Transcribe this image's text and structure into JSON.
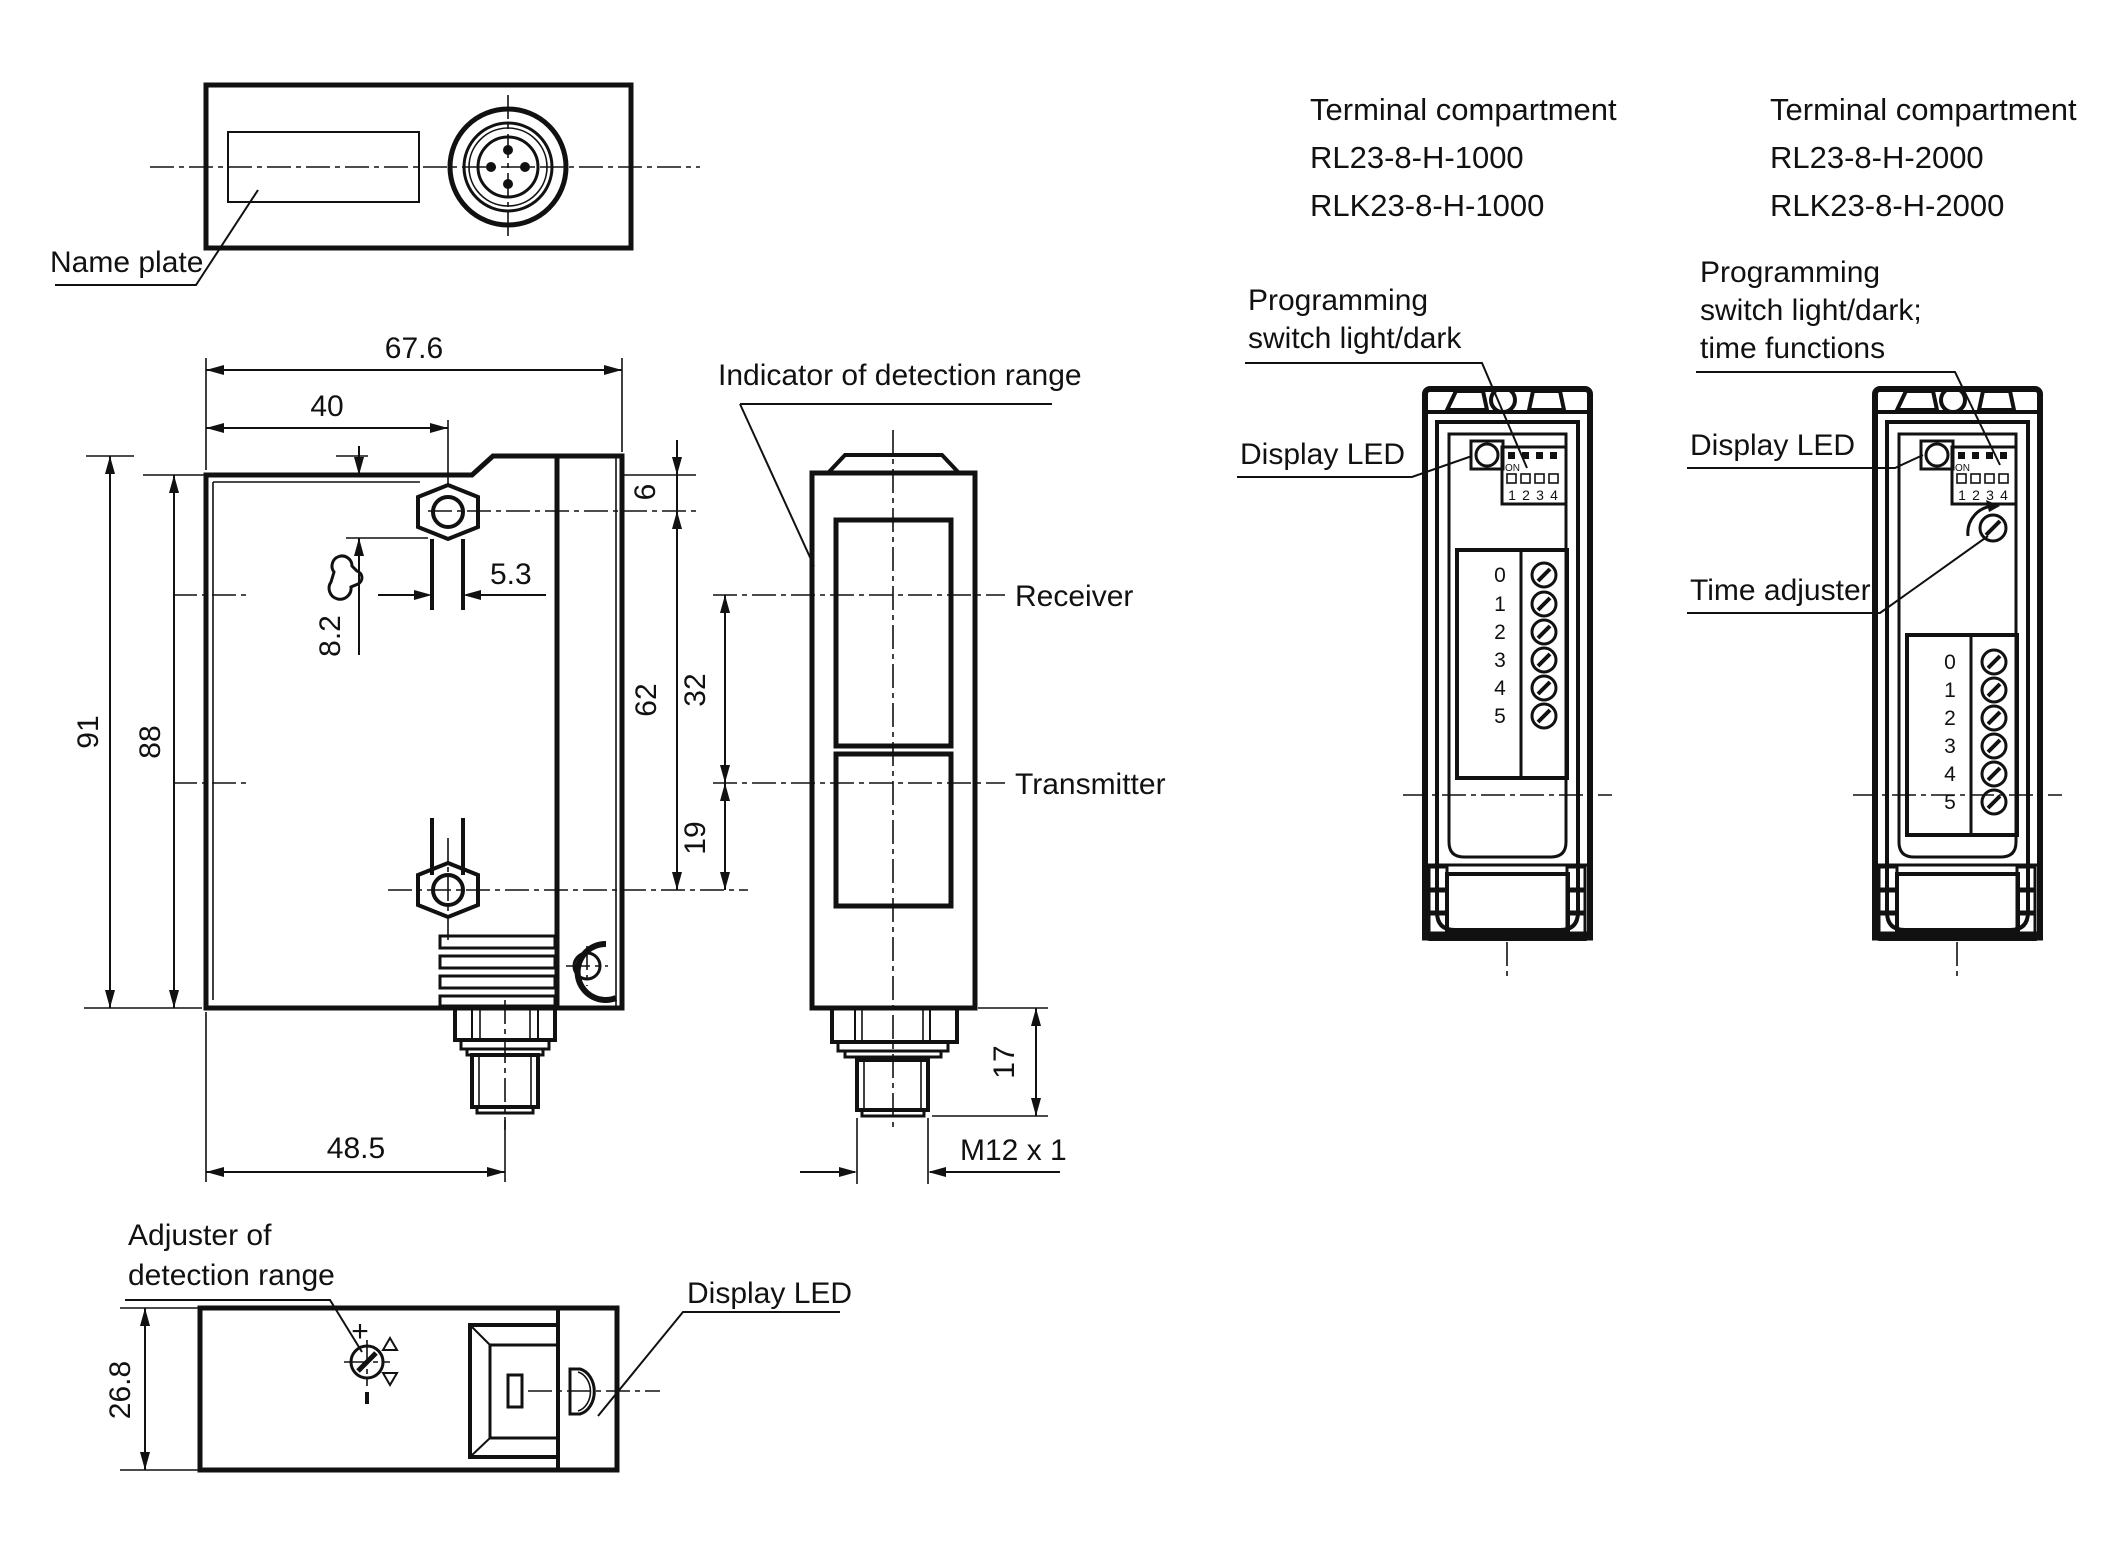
{
  "views": {
    "top": {
      "name_plate_label": "Name plate"
    },
    "front": {
      "dim_width": "67.6",
      "dim_hole_x": "40",
      "dim_height_outer": "91",
      "dim_height_inner": "88",
      "dim_top_to_hole": "6",
      "dim_slot": "5.3",
      "dim_wrench": "8.2",
      "dim_connector_x": "48.5"
    },
    "side": {
      "indicator_label": "Indicator of detection range",
      "receiver_label": "Receiver",
      "transmitter_label": "Transmitter",
      "dim_hole_spacing": "62",
      "dim_axes": "32",
      "dim_lower": "19",
      "dim_connector_len": "17",
      "thread_label": "M12 x 1"
    },
    "bottom": {
      "adjuster_label_line1": "Adjuster of",
      "adjuster_label_line2": "detection range",
      "display_led_label": "Display LED",
      "dim_depth": "26.8",
      "plus_sign": "+"
    },
    "compartment1": {
      "title": "Terminal compartment",
      "model1": "RL23-8-H-1000",
      "model2": "RLK23-8-H-1000",
      "programming_line1": "Programming",
      "programming_line2": "switch light/dark",
      "display_led_label": "Display LED",
      "dip_on": "ON",
      "dip_numbers": [
        "1",
        "2",
        "3",
        "4"
      ],
      "terminal_numbers": [
        "0",
        "1",
        "2",
        "3",
        "4",
        "5"
      ]
    },
    "compartment2": {
      "title": "Terminal compartment",
      "model1": "RL23-8-H-2000",
      "model2": "RLK23-8-H-2000",
      "programming_line1": "Programming",
      "programming_line2": "switch light/dark;",
      "programming_line3": "time functions",
      "display_led_label": "Display LED",
      "time_adjuster_label": "Time adjuster",
      "dip_on": "ON",
      "dip_numbers": [
        "1",
        "2",
        "3",
        "4"
      ],
      "terminal_numbers": [
        "0",
        "1",
        "2",
        "3",
        "4",
        "5"
      ]
    }
  },
  "colors": {
    "line": "#111111",
    "background": "#ffffff"
  }
}
